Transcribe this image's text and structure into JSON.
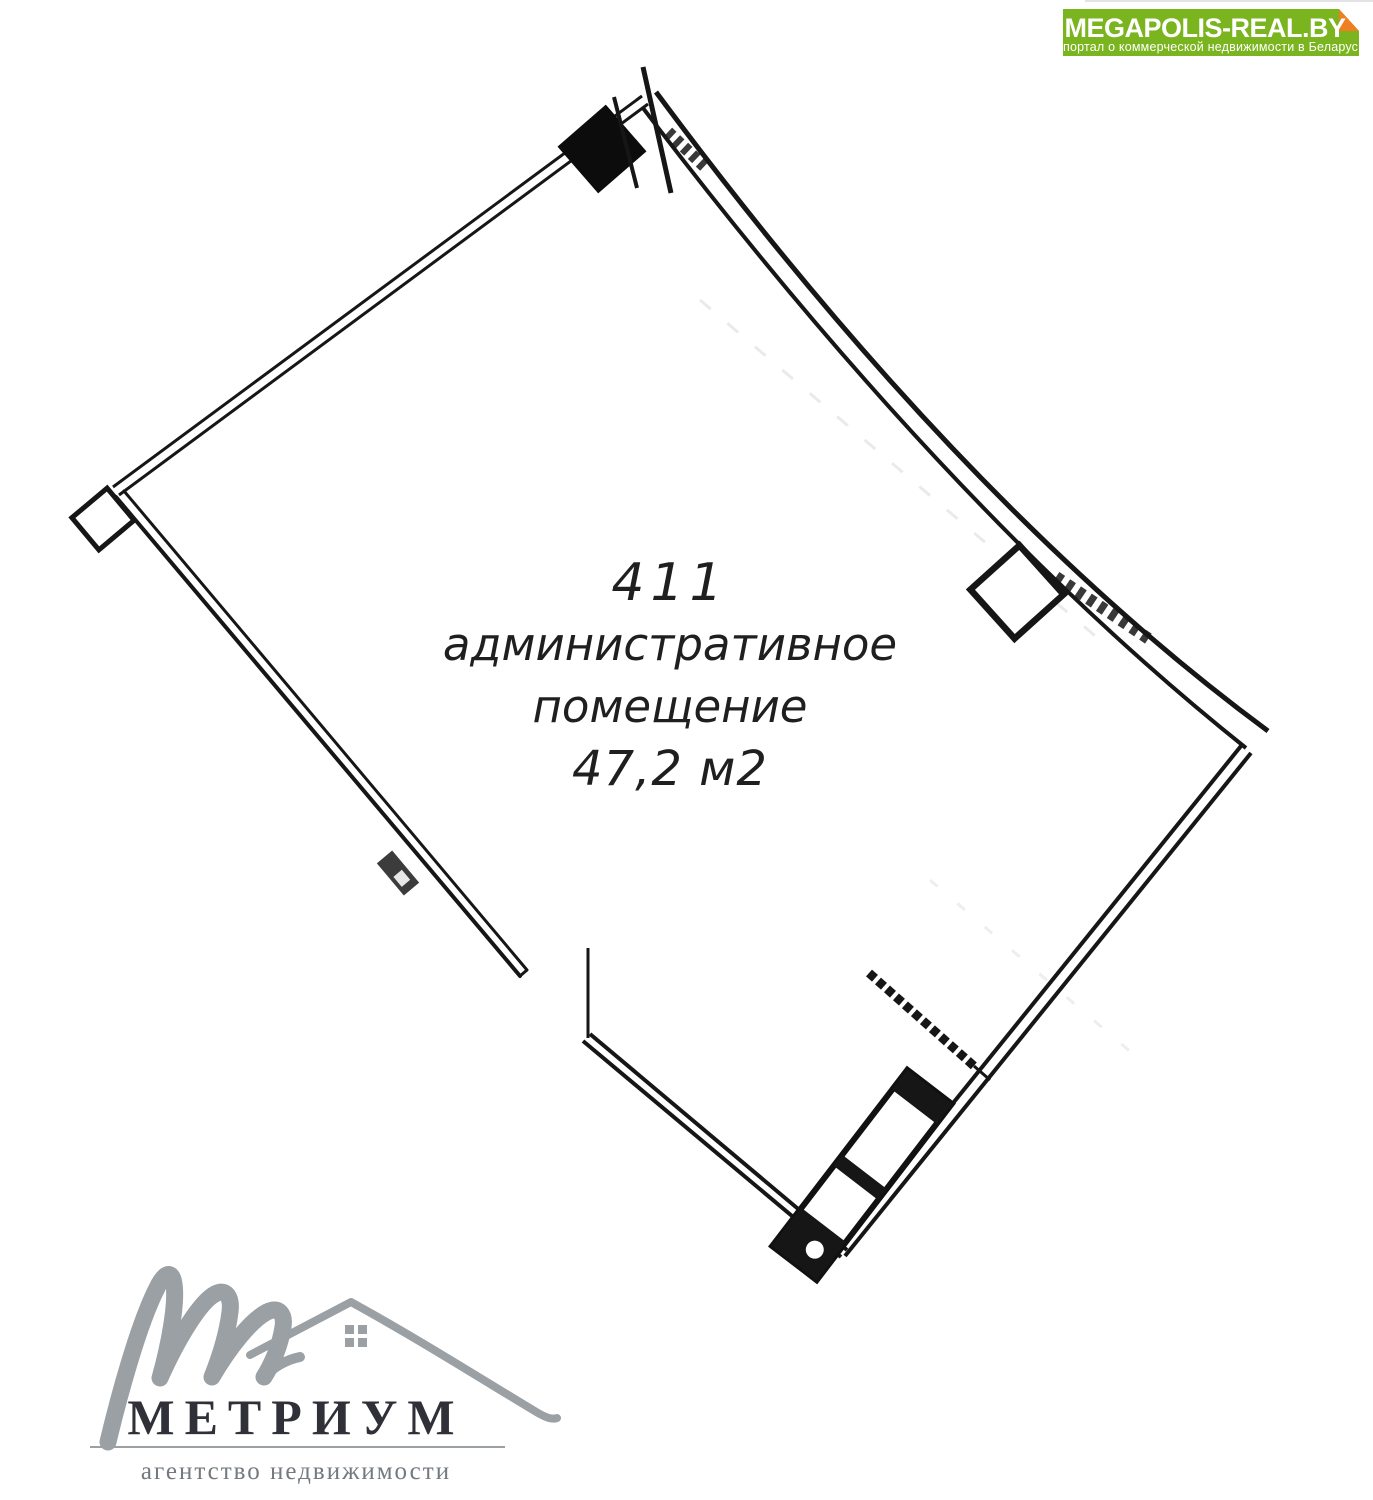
{
  "banner": {
    "title": "MEGAPOLIS-REAL.BY",
    "subtitle": "портал о коммерческой недвижимости в Беларуси",
    "bg_color": "#7ab41e",
    "fold_color": "#ef7f23",
    "text_color": "#ffffff"
  },
  "floorplan": {
    "unit_number": "411",
    "label_line1": "административное",
    "label_line2": "помещение",
    "area": "47,2 м2",
    "line_color": "#161616"
  },
  "agency": {
    "name": "МЕТРИУМ",
    "tagline": "агентство недвижимости",
    "logo_color": "#9aa0a4",
    "name_color": "#2f3038",
    "tagline_color": "#73797e"
  }
}
